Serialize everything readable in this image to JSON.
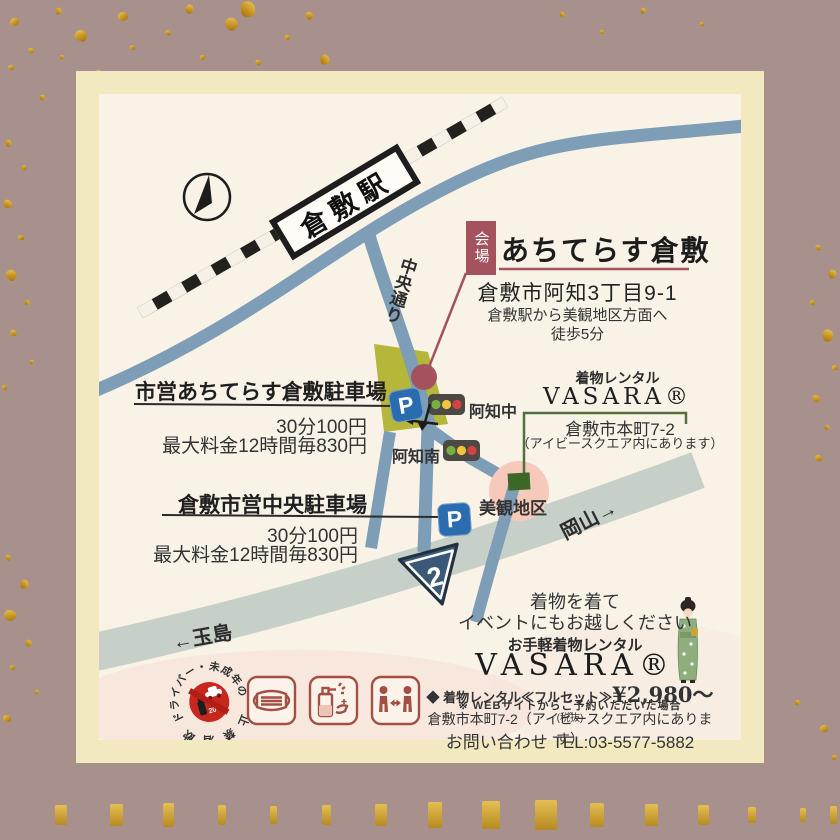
{
  "map": {
    "station_label": "倉敷駅",
    "street_label": "中央通り",
    "venue_tag": "会場",
    "venue_name": "あちてらす倉敷",
    "venue_address": "倉敷市阿知3丁目9-1",
    "venue_access_line1": "倉敷駅から美観地区方面へ",
    "venue_access_line2": "徒歩5分",
    "parking1": {
      "name": "市営あちてらす倉敷駐車場",
      "rate": "30分100円",
      "max": "最大料金12時間毎830円"
    },
    "parking2": {
      "name": "倉敷市営中央駐車場",
      "rate": "30分100円",
      "max": "最大料金12時間毎830円"
    },
    "signal_naka": "阿知中",
    "signal_minami": "阿知南",
    "bikan_label": "美観地区",
    "okayama_label": "岡山→",
    "tamashima_label": "←玉島",
    "route_number": "2",
    "parking_letter": "P",
    "rental_tag": "着物レンタル",
    "rental_name": "VASARA®",
    "rental_address": "倉敷市本町7-2",
    "rental_note": "（アイビースクエア内にあります）"
  },
  "promo": {
    "line1": "着物を着て",
    "line2": "イベントにもお越しください",
    "subtitle": "お手軽着物レンタル",
    "brand": "VASARA®",
    "price_prefix": "◆ 着物レンタル≪フルセット≫",
    "price": "¥2,980〜",
    "price_suffix": "(税抜)",
    "note": "※ WEBサイトからご予約いただいた場合",
    "address": "倉敷市本町7-2（アイビースクエア内にあります）",
    "contact": "お問い合わせ TEL:03-5577-5882"
  },
  "stamp": {
    "arc_top": "ドライバー・未成年の",
    "arc_bottom_chars": [
      "飲",
      "酒",
      "禁",
      "止"
    ],
    "age": "20"
  },
  "colors": {
    "bg_mauve": "#a8918c",
    "cream": "#f3e9c0",
    "paper": "#f9f2e6",
    "gold": "#c89422",
    "road_blue": "#7e9db6",
    "road_gray": "#c6cfc8",
    "venue_olive": "#b5b73a",
    "accent_maroon": "#a3525e",
    "pink_area": "#f6c9ba",
    "green_marker": "#3c6827",
    "green_line": "#52703d",
    "parking_blue": "#2b6cb0",
    "signal_body": "#4b4942",
    "signal_green": "#76b043",
    "signal_yellow": "#efc53f",
    "signal_red": "#d24444",
    "route_navy": "#3b5977",
    "icon_red": "#a34f44",
    "prohibit_red": "#c8271d",
    "text_dark": "#333333"
  }
}
